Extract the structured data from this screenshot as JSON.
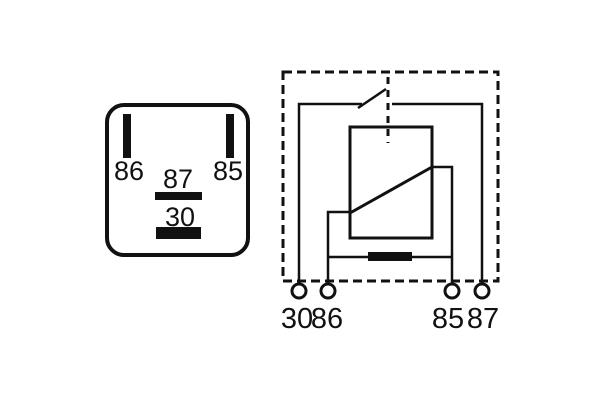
{
  "figure": {
    "type": "automotive-relay-diagram",
    "background_color": "#ffffff",
    "line_color": "#111111"
  },
  "pinout_view": {
    "pin_86_label": "86",
    "pin_85_label": "85",
    "pin_87_label": "87",
    "pin_30_label": "30"
  },
  "schematic_view": {
    "terminal_30_label": "30",
    "terminal_86_label": "86",
    "terminal_85_label": "85",
    "terminal_87_label": "87",
    "symbols": {
      "coil": "relay-coil-box-with-diagonal",
      "resistor": "parallel-resistor-bar",
      "switch": "normally-open-contact",
      "enclosure": "dashed-relay-housing"
    }
  }
}
